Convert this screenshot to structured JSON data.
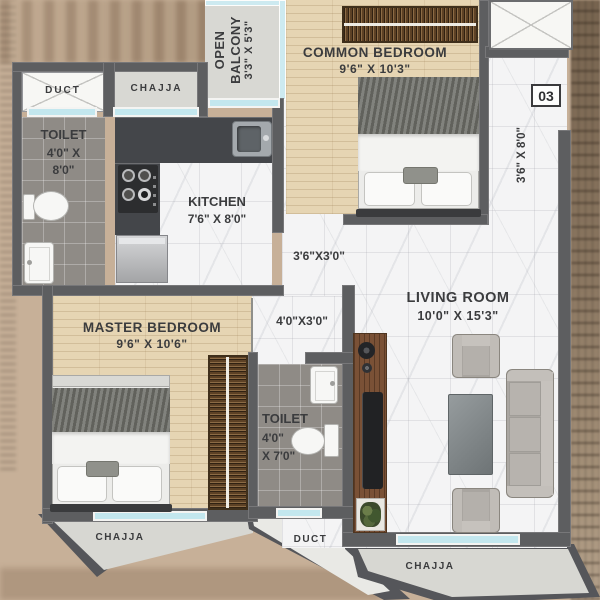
{
  "floor_plan": {
    "unit_number": "03",
    "labels": {
      "open_balcony": {
        "line1": "OPEN",
        "line2": "BALCONY",
        "dims": "3'3\" X 5'3\""
      },
      "chajja_top": "CHAJJA",
      "duct_top": "DUCT",
      "toilet_1": {
        "name": "TOILET",
        "dims1": "4'0\" X",
        "dims2": "8'0\""
      },
      "kitchen": {
        "name": "KITCHEN",
        "dims": "7'6\" X 8'0\""
      },
      "common_bedroom": {
        "name": "COMMON BEDROOM",
        "dims": "9'6\" X 10'3\""
      },
      "entry_passage_dims": "3'6\" X 8'0\"",
      "passage_1_dims": "3'6\"X3'0\"",
      "passage_2_dims": "4'0\"X3'0\"",
      "living_room": {
        "name": "LIVING ROOM",
        "dims": "10'0\" X 15'3\""
      },
      "master_bedroom": {
        "name": "MASTER BEDROOM",
        "dims": "9'6\" X 10'6\""
      },
      "toilet_2": {
        "name": "TOILET",
        "dims1": "4'0\"",
        "dims2": "X 7'0\""
      },
      "chajja_bottom_left": "CHAJJA",
      "duct_bottom": "DUCT",
      "chajja_bottom_right": "CHAJJA"
    },
    "colors": {
      "wall": "#5d5e60",
      "window_glass": "#c3e7ee",
      "wood_floor": "#e6d5b3",
      "marble_floor": "#f4f4f5",
      "tile_floor": "#8f8b86",
      "kitchen_counter": "#44464a",
      "furniture_wood": "#5d4226",
      "background": "#c7b098"
    }
  }
}
